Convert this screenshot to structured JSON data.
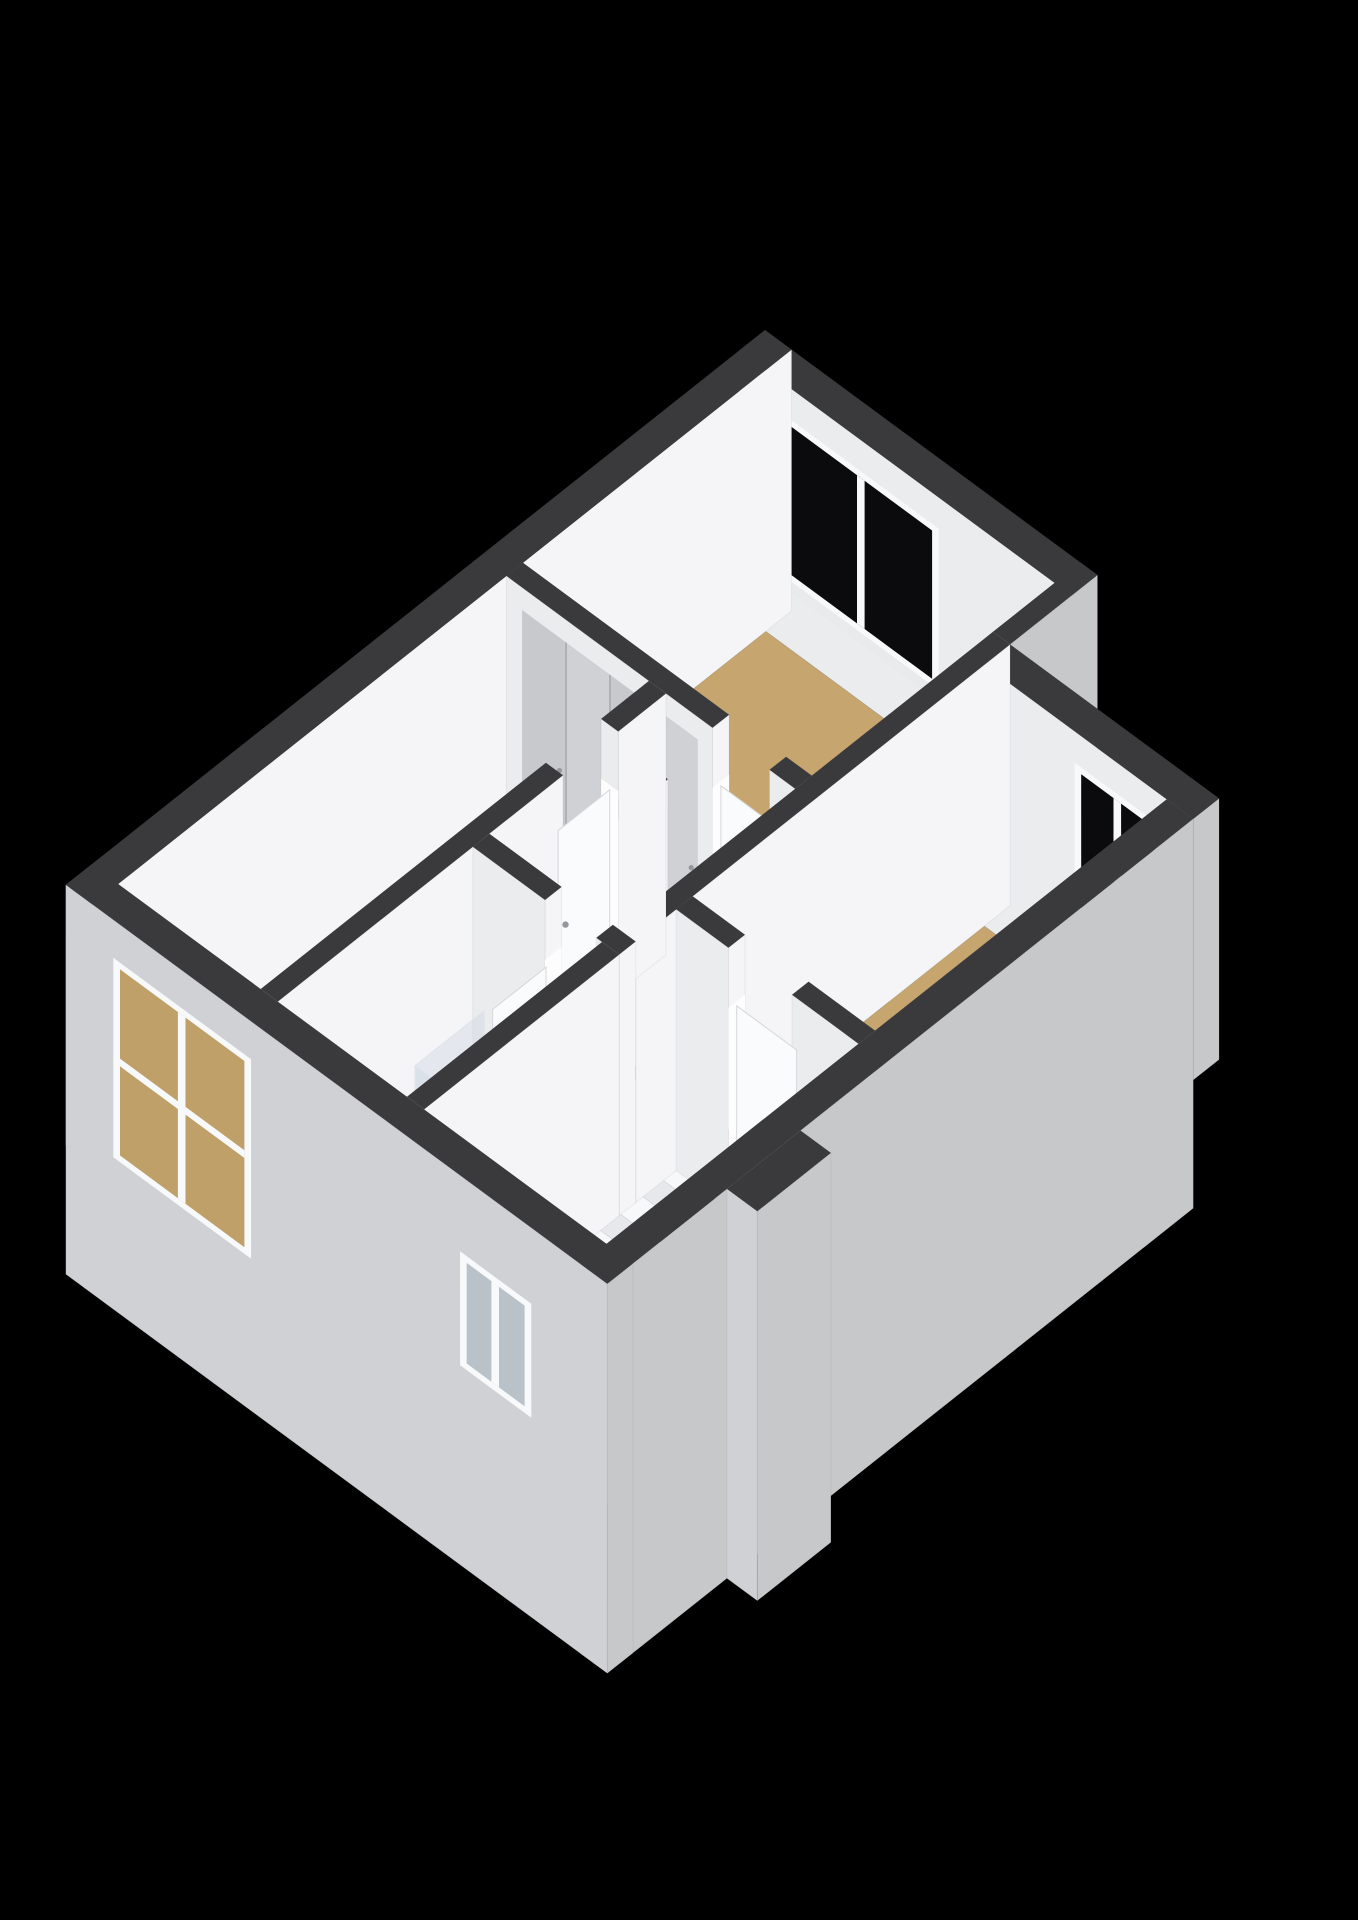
{
  "scene": {
    "description": "3d-floorplan-render-upper-floor",
    "canvas": {
      "width": 1358,
      "height": 1920,
      "background": "#000000"
    }
  },
  "palette": {
    "bg": "#000000",
    "rim": "#3a3a3c",
    "face_u": "#f5f5f7",
    "face_v": "#ebecee",
    "exterior_u": "#c7c8ca",
    "exterior_v": "#d0d1d4",
    "jamb": "#fdfdfe",
    "floor_tan": "#c6a56e",
    "floor_bath": "#b9c3cd",
    "floor_wc": "#c4ccd4",
    "pit": "#0a0a0b",
    "pit_side": "#17171a",
    "step_top": "#f7f8fa",
    "step_riser": "#e7e8eb",
    "closet_a": "#c8c9cd",
    "closet_b": "#d0d1d5",
    "closet_seam": "#a7a8ad",
    "handle": "#96979c",
    "frame": "#f8f9fa",
    "sill": "#e9eaec",
    "glass_dark": "#0b0b0d",
    "glass_room_tan": "#bfa069",
    "glass_room_blue": "#b9c1c9",
    "door_leaf": "#fafbfc",
    "door_edge": "#d6d7da",
    "wood_u": "#cbb290",
    "wood_v": "#bfa47f",
    "vanity_top": "#fafbfd",
    "basin": "#e9edf0",
    "metal": "#9aa0a6",
    "tray": "#c6cfd7",
    "glass_pane": "rgba(208,218,226,0.45)",
    "glass_edge": "#dde4ea",
    "toilet_u": "#f2f3f5",
    "toilet_v": "#e8eaed",
    "toilet_top": "#fcfdfe"
  },
  "projection": {
    "origin": [
      765,
      330
    ],
    "u": [
      95,
      70
    ],
    "v": [
      -92,
      73
    ],
    "z": 95,
    "wall_top": 2.75
  },
  "building": {
    "floors": [
      {
        "name": "floor-bedroom-top",
        "rect": [
          0.28,
          0.28,
          3.32,
          2.92
        ],
        "color": "floor_tan"
      },
      {
        "name": "floor-bedroom-right",
        "rect": [
          3.5,
          1.23,
          5.42,
          4.4
        ],
        "color": "floor_tan"
      },
      {
        "name": "floor-bedroom-left",
        "rect": [
          0.28,
          3.1,
          1.78,
          7.32
        ],
        "color": "floor_tan"
      },
      {
        "name": "floor-hall-landing",
        "rect": [
          1.96,
          2.92,
          3.32,
          5.02
        ],
        "color": "floor_tan"
      },
      {
        "name": "floor-bathroom",
        "rect": [
          1.96,
          5.2,
          3.32,
          7.32
        ],
        "color": "floor_bath"
      },
      {
        "name": "floor-wc",
        "rect": [
          3.5,
          4.58,
          5.42,
          7.32
        ],
        "color": "floor_wc"
      }
    ],
    "walls": [
      {
        "name": "facade-nw",
        "box": [
          0,
          0,
          0.28,
          7.6
        ],
        "z": [
          0,
          2.75
        ],
        "cu": "face_u",
        "cv": "exterior_v"
      },
      {
        "name": "facade-ne",
        "box": [
          0,
          0,
          3.5,
          0.28
        ],
        "z": [
          0,
          2.75
        ],
        "cu": "exterior_u",
        "cv": "face_v",
        "windows": [
          "top_bedroom_window"
        ]
      },
      {
        "name": "facade-ne-step",
        "box": [
          3.32,
          0,
          3.5,
          0.95
        ],
        "z": [
          0,
          2.75
        ],
        "cu": "exterior_u",
        "cv": "exterior_v"
      },
      {
        "name": "facade-ne-setback",
        "box": [
          3.5,
          0.95,
          5.7,
          1.23
        ],
        "z": [
          0,
          2.75
        ],
        "cu": "exterior_u",
        "cv": "face_v",
        "windows": [
          "right_bedroom_window"
        ]
      },
      {
        "name": "facade-se",
        "box": [
          5.42,
          1.23,
          5.7,
          7.6
        ],
        "z": [
          -1.35,
          2.75
        ],
        "cu": "exterior_u",
        "cv": "exterior_v"
      },
      {
        "name": "facade-se-bump",
        "box": [
          5.7,
          5.5,
          6.02,
          6.3
        ],
        "z": [
          -1.35,
          2.75
        ],
        "cu": "exterior_u",
        "cv": "exterior_v",
        "key": 11.8
      },
      {
        "name": "facade-sw",
        "box": [
          0,
          7.32,
          5.7,
          7.6
        ],
        "z": [
          -1.35,
          2.75
        ],
        "cu": "exterior_u",
        "cv": "exterior_v",
        "windows": [
          "left_bedroom_window",
          "wc_window"
        ],
        "key": 10.4
      },
      {
        "name": "wall-bedroom-top-south",
        "box": [
          0.28,
          2.92,
          3.32,
          3.1
        ],
        "z": [
          0,
          2.75
        ],
        "gap": {
          "axis": "u",
          "range": [
            2.45,
            3.05
          ]
        },
        "door": "bedroom_top_door",
        "closet": true
      },
      {
        "name": "wall-bedroom-left-east",
        "box": [
          1.78,
          3.1,
          1.96,
          7.32
        ],
        "z": [
          0,
          2.75
        ],
        "gap": {
          "axis": "v",
          "range": [
            3.62,
            4.22
          ]
        },
        "door": "bedroom_left_door"
      },
      {
        "name": "wall-hall-divider",
        "box": [
          3.32,
          0.95,
          3.5,
          5.02
        ],
        "z": [
          0,
          2.75
        ]
      },
      {
        "name": "wall-bedroom-right-south",
        "box": [
          3.5,
          4.4,
          5.42,
          4.58
        ],
        "z": [
          0,
          2.75
        ],
        "gap": {
          "axis": "u",
          "range": [
            4.05,
            4.72
          ]
        },
        "door": "bedroom_right_door"
      },
      {
        "name": "wall-bathroom-north",
        "box": [
          1.96,
          5.02,
          3.5,
          5.2
        ],
        "z": [
          0,
          2.75
        ],
        "gap": {
          "axis": "u",
          "range": [
            2.72,
            3.26
          ]
        },
        "door": "bathroom_door_open"
      },
      {
        "name": "wall-bathroom-east",
        "box": [
          3.32,
          5.2,
          3.5,
          7.32
        ],
        "z": [
          0,
          2.75
        ]
      },
      {
        "name": "wall-stairwell-west",
        "box": [
          2.42,
          3.7,
          2.56,
          5.02
        ],
        "z": [
          0,
          2.75
        ],
        "key": 5.3
      }
    ],
    "windows": {
      "top_bedroom_window": {
        "at": 0.28,
        "span": [
          0.45,
          2.1
        ],
        "z": [
          0.72,
          2.42
        ],
        "mullions": [
          1.28
        ],
        "rails": [],
        "glass": "glass_dark",
        "sill": true
      },
      "right_bedroom_window": {
        "at": 1.23,
        "span": [
          4.45,
          5.35
        ],
        "z": [
          0.72,
          2.42
        ],
        "mullions": [
          4.9
        ],
        "rails": [],
        "glass": "glass_dark",
        "sill": true
      },
      "left_bedroom_window": {
        "at": 7.6,
        "span": [
          0.5,
          1.95
        ],
        "z": [
          0.25,
          2.35
        ],
        "mullions": [
          1.22
        ],
        "rails": [
          1.3
        ],
        "glass": "glass_room_tan",
        "sill": false
      },
      "wc_window": {
        "at": 7.6,
        "span": [
          4.15,
          4.9
        ],
        "z": [
          0.75,
          1.95
        ],
        "mullions": [
          4.52
        ],
        "rails": [],
        "glass": "glass_room_blue",
        "sill": false
      }
    },
    "doors": {
      "bedroom_top_door": {
        "plane": "V",
        "at": 3.03,
        "span": [
          2.47,
          3.03
        ],
        "z": [
          0.02,
          2.1
        ],
        "handle": [
          2.96,
          3.03,
          1.05
        ]
      },
      "bedroom_left_door": {
        "plane": "U",
        "at": 1.89,
        "span": [
          3.64,
          4.2
        ],
        "z": [
          0.02,
          2.1
        ],
        "handle": [
          1.89,
          4.12,
          1.05
        ]
      },
      "bedroom_right_door": {
        "plane": "V",
        "at": 4.51,
        "span": [
          4.07,
          4.7
        ],
        "z": [
          0.02,
          2.1
        ],
        "handle": [
          4.63,
          4.51,
          1.05
        ]
      },
      "bathroom_door_open": {
        "plane": "U",
        "at": 2.75,
        "span": [
          5.22,
          5.8
        ],
        "z": [
          0.02,
          2.08
        ],
        "handle": [
          2.75,
          5.72,
          1.05
        ]
      }
    },
    "closet": {
      "at": 3.105,
      "span": [
        0.45,
        2.3
      ],
      "z": [
        0.02,
        2.52
      ],
      "panels": 4
    },
    "stairs": {
      "well": [
        2.56,
        3.7,
        3.32,
        5.02
      ],
      "pit_z": -1.35,
      "steps": [
        {
          "v": [
            3.7,
            4.16
          ],
          "z": -0.14
        },
        {
          "v": [
            4.16,
            4.4
          ],
          "z": -0.47
        },
        {
          "v": [
            4.4,
            4.64
          ],
          "z": -0.8
        },
        {
          "v": [
            4.64,
            4.88
          ],
          "z": -1.13
        },
        {
          "v": [
            4.88,
            5.02
          ],
          "z": -1.46
        }
      ],
      "key": 5.45
    },
    "fixtures": {
      "vanity": {
        "box": [
          2.04,
          5.28,
          2.66,
          5.66
        ],
        "h": 0.8,
        "basin": [
          2.12,
          5.33,
          2.58,
          5.58
        ],
        "faucet": [
          2.18,
          5.36,
          0.95
        ],
        "key": 7.9
      },
      "shower": {
        "tray": [
          2.66,
          5.8,
          3.32,
          6.55
        ],
        "glass_h": 2.0,
        "key": 9.2
      },
      "toilet": {
        "tank": [
          4.42,
          5.38,
          4.6,
          5.66
        ],
        "tank_h": 0.72,
        "bowl": [
          4.24,
          5.52,
          0.38
        ],
        "key": 9.95
      }
    }
  }
}
